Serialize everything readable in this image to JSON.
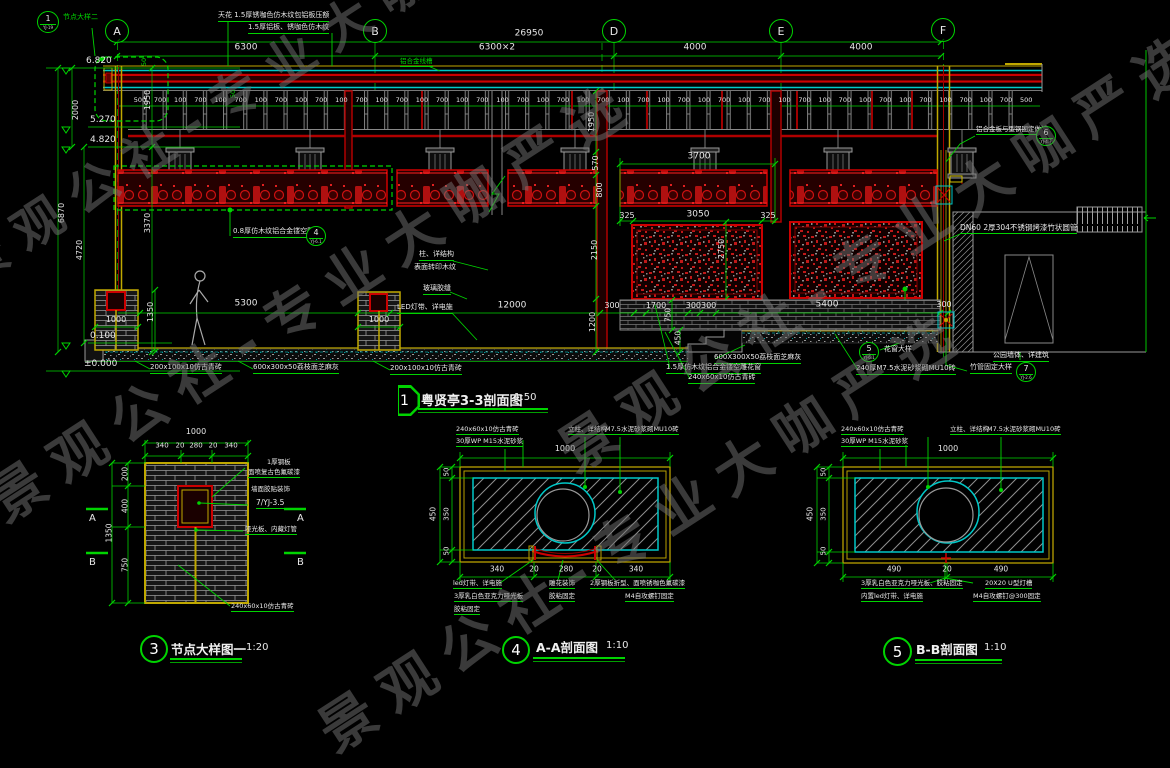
{
  "watermark": {
    "text": "景观公社-专业大咖严选"
  },
  "palette": {
    "green": "#00d400",
    "red": "#cc0000",
    "cyan": "#00c8c8",
    "yellow": "#c0a800",
    "white": "#e8e8e8",
    "bg": "#000000"
  },
  "grid_bubbles": {
    "labels": [
      "A",
      "B",
      "D",
      "E",
      "F"
    ]
  },
  "titles": [
    {
      "num": "1",
      "name": "粤贤亭3-3剖面图",
      "scale": "1:50"
    },
    {
      "num": "3",
      "name": "节点大样图一",
      "scale": "1:20"
    },
    {
      "num": "4",
      "name": "A-A剖面图",
      "scale": "1:10"
    },
    {
      "num": "5",
      "name": "B-B剖面图",
      "scale": "1:10"
    }
  ],
  "detail_bubbles": [
    {
      "num": "1",
      "ref": "YJ-19"
    },
    {
      "num": "4",
      "ref": "YJ-6.1"
    },
    {
      "num": "5",
      "ref": "YJ-6.1"
    },
    {
      "num": "6",
      "ref": "YJ-4.7"
    },
    {
      "num": "7",
      "ref": "YJ-2.6"
    }
  ],
  "rail_dims": {
    "values": [
      "500",
      "700",
      "100",
      "700",
      "100",
      "700",
      "100",
      "700",
      "100",
      "700",
      "100",
      "700",
      "100",
      "700",
      "100",
      "700",
      "100",
      "700",
      "100",
      "700",
      "100",
      "700",
      "100",
      "700",
      "100",
      "700",
      "100",
      "700",
      "100",
      "700",
      "100",
      "700",
      "100",
      "700",
      "100",
      "700",
      "100",
      "700",
      "100",
      "700",
      "100",
      "700",
      "100",
      "700",
      "500"
    ]
  },
  "watermarks": [
    {
      "x": -30,
      "y": 470,
      "rot": -33,
      "size": 56
    },
    {
      "x": 300,
      "y": 700,
      "rot": -33,
      "size": 56
    },
    {
      "x": 540,
      "y": 420,
      "rot": -33,
      "size": 56
    },
    {
      "x": -60,
      "y": 240,
      "rot": -33,
      "size": 50
    }
  ],
  "annotations": [
    {
      "t": "26950",
      "x": 529,
      "y": 34,
      "c": "w",
      "s": 9,
      "a": "c"
    },
    {
      "t": "6300",
      "x": 246,
      "y": 48,
      "c": "w",
      "s": 9,
      "a": "c"
    },
    {
      "t": "6300×2",
      "x": 497,
      "y": 48,
      "c": "w",
      "s": 9,
      "a": "c"
    },
    {
      "t": "4000",
      "x": 695,
      "y": 48,
      "c": "w",
      "s": 9,
      "a": "c"
    },
    {
      "t": "4000",
      "x": 861,
      "y": 48,
      "c": "w",
      "s": 9,
      "a": "c"
    },
    {
      "t": "天花 1.5厚锈咖色仿木纹包铝板压额",
      "x": 218,
      "y": 12,
      "c": "w",
      "s": 7,
      "u": 1
    },
    {
      "t": "1.5厚铝板、锈咖色仿木纹",
      "x": 248,
      "y": 24,
      "c": "w",
      "s": 7,
      "u": 1
    },
    {
      "t": "铝合金线槽",
      "x": 400,
      "y": 58,
      "c": "g",
      "s": 6.5,
      "u": 1
    },
    {
      "t": "节点大样二",
      "x": 63,
      "y": 14,
      "c": "g",
      "s": 7
    },
    {
      "t": "6.820",
      "x": 86,
      "y": 57,
      "c": "w",
      "s": 9
    },
    {
      "t": "5.270",
      "x": 90,
      "y": 116,
      "c": "w",
      "s": 9
    },
    {
      "t": "4.820",
      "x": 90,
      "y": 136,
      "c": "w",
      "s": 9
    },
    {
      "t": "0.100",
      "x": 90,
      "y": 332,
      "c": "w",
      "s": 9
    },
    {
      "t": "±0.000",
      "x": 84,
      "y": 360,
      "c": "w",
      "s": 9
    },
    {
      "t": "2000",
      "x": 76,
      "y": 110,
      "r": 1,
      "c": "w",
      "s": 8
    },
    {
      "t": "6870",
      "x": 62,
      "y": 213,
      "r": 1,
      "c": "w",
      "s": 8
    },
    {
      "t": "4720",
      "x": 80,
      "y": 250,
      "r": 1,
      "c": "w",
      "s": 8
    },
    {
      "t": "1950",
      "x": 148,
      "y": 100,
      "r": 1,
      "c": "w",
      "s": 8
    },
    {
      "t": "3370",
      "x": 148,
      "y": 223,
      "r": 1,
      "c": "w",
      "s": 8
    },
    {
      "t": "50",
      "x": 144,
      "y": 62,
      "r": 1,
      "c": "g",
      "s": 6.5
    },
    {
      "t": "50",
      "x": 233,
      "y": 94,
      "r": 1,
      "c": "g",
      "s": 6.5
    },
    {
      "t": "1950",
      "x": 592,
      "y": 122,
      "r": 1,
      "c": "w",
      "s": 8
    },
    {
      "t": "570",
      "x": 596,
      "y": 163,
      "r": 1,
      "c": "w",
      "s": 8
    },
    {
      "t": "800",
      "x": 600,
      "y": 190,
      "r": 1,
      "c": "w",
      "s": 8
    },
    {
      "t": "2150",
      "x": 595,
      "y": 250,
      "r": 1,
      "c": "w",
      "s": 8
    },
    {
      "t": "1200",
      "x": 593,
      "y": 322,
      "r": 1,
      "c": "w",
      "s": 8
    },
    {
      "t": "2750",
      "x": 722,
      "y": 249,
      "r": 1,
      "c": "w",
      "s": 8
    },
    {
      "t": "750",
      "x": 668,
      "y": 315,
      "r": 1,
      "c": "w",
      "s": 7.5
    },
    {
      "t": "450",
      "x": 678,
      "y": 338,
      "r": 1,
      "c": "w",
      "s": 7.5
    },
    {
      "t": "1350",
      "x": 151,
      "y": 312,
      "r": 1,
      "c": "w",
      "s": 8
    },
    {
      "t": "3700",
      "x": 699,
      "y": 157,
      "c": "w",
      "s": 9,
      "a": "c"
    },
    {
      "t": "325",
      "x": 627,
      "y": 216,
      "c": "w",
      "s": 8,
      "a": "c"
    },
    {
      "t": "3050",
      "x": 698,
      "y": 215,
      "c": "w",
      "s": 9,
      "a": "c"
    },
    {
      "t": "325",
      "x": 768,
      "y": 216,
      "c": "w",
      "s": 8,
      "a": "c"
    },
    {
      "t": "5300",
      "x": 246,
      "y": 304,
      "c": "w",
      "s": 9,
      "a": "c"
    },
    {
      "t": "1000",
      "x": 116,
      "y": 320,
      "c": "w",
      "s": 8,
      "a": "c"
    },
    {
      "t": "1000",
      "x": 379,
      "y": 320,
      "c": "w",
      "s": 8,
      "a": "c"
    },
    {
      "t": "12000",
      "x": 512,
      "y": 306,
      "c": "w",
      "s": 9,
      "a": "c"
    },
    {
      "t": "300",
      "x": 612,
      "y": 306,
      "c": "w",
      "s": 8,
      "a": "c"
    },
    {
      "t": "1700",
      "x": 656,
      "y": 306,
      "c": "w",
      "s": 8,
      "a": "c"
    },
    {
      "t": "300300",
      "x": 701,
      "y": 306,
      "c": "w",
      "s": 8,
      "a": "c"
    },
    {
      "t": "5400",
      "x": 827,
      "y": 305,
      "c": "w",
      "s": 9,
      "a": "c"
    },
    {
      "t": "300",
      "x": 944,
      "y": 305,
      "c": "w",
      "s": 8,
      "a": "c"
    },
    {
      "t": "柱、详结构",
      "x": 419,
      "y": 251,
      "c": "w",
      "s": 7,
      "u": 1
    },
    {
      "t": "表面转印木纹",
      "x": 414,
      "y": 264,
      "c": "w",
      "s": 7
    },
    {
      "t": "玻璃胶缝",
      "x": 423,
      "y": 285,
      "c": "w",
      "s": 7,
      "u": 1
    },
    {
      "t": "LED灯带、详电施",
      "x": 397,
      "y": 304,
      "c": "w",
      "s": 7,
      "u": 1
    },
    {
      "t": "0.8厚仿木纹铝合金镂空雕花",
      "x": 233,
      "y": 228,
      "c": "w",
      "s": 7,
      "u": 1
    },
    {
      "t": "200x100x10仿古青砖",
      "x": 150,
      "y": 364,
      "c": "w",
      "s": 7,
      "u": 1
    },
    {
      "t": "600x300x50荔枝面芝麻灰",
      "x": 253,
      "y": 364,
      "c": "w",
      "s": 7,
      "u": 1
    },
    {
      "t": "200x100x10仿古青砖",
      "x": 390,
      "y": 365,
      "c": "w",
      "s": 7,
      "u": 1
    },
    {
      "t": "600X300X50荔枝面芝麻灰",
      "x": 714,
      "y": 354,
      "c": "w",
      "s": 7,
      "u": 1
    },
    {
      "t": "1.5厚仿木纹铝合金镂空雕花窗",
      "x": 666,
      "y": 364,
      "c": "w",
      "s": 7,
      "u": 1
    },
    {
      "t": "240x60x10仿古青砖",
      "x": 688,
      "y": 374,
      "c": "w",
      "s": 7,
      "u": 1
    },
    {
      "t": "240厚M7.5水泥砂浆砌MU10砖",
      "x": 856,
      "y": 365,
      "c": "w",
      "s": 7,
      "u": 1
    },
    {
      "t": "公园墙体、详建筑",
      "x": 993,
      "y": 352,
      "c": "w",
      "s": 7,
      "u": 1
    },
    {
      "t": "竹管固定大样",
      "x": 970,
      "y": 364,
      "c": "w",
      "s": 7,
      "u": 1
    },
    {
      "t": "花窗大样",
      "x": 884,
      "y": 346,
      "c": "w",
      "s": 7
    },
    {
      "t": "DN60 2厚304不锈钢烤漆竹状圆管",
      "x": 960,
      "y": 224,
      "c": "w",
      "s": 7.5,
      "u": 1
    },
    {
      "t": "铝合金板与型钢固定做法",
      "x": 976,
      "y": 126,
      "c": "w",
      "s": 6.5,
      "u": 1
    },
    {
      "t": "1000",
      "x": 196,
      "y": 432,
      "c": "w",
      "s": 8,
      "a": "c"
    },
    {
      "t": "340",
      "x": 162,
      "y": 446,
      "c": "w",
      "s": 7,
      "a": "c"
    },
    {
      "t": "20",
      "x": 180,
      "y": 446,
      "c": "w",
      "s": 7,
      "a": "c"
    },
    {
      "t": "280",
      "x": 196,
      "y": 446,
      "c": "w",
      "s": 7,
      "a": "c"
    },
    {
      "t": "20",
      "x": 213,
      "y": 446,
      "c": "w",
      "s": 7,
      "a": "c"
    },
    {
      "t": "340",
      "x": 231,
      "y": 446,
      "c": "w",
      "s": 7,
      "a": "c"
    },
    {
      "t": "200",
      "x": 125,
      "y": 474,
      "r": 1,
      "c": "w",
      "s": 7.5
    },
    {
      "t": "400",
      "x": 125,
      "y": 506,
      "r": 1,
      "c": "w",
      "s": 7.5
    },
    {
      "t": "750",
      "x": 125,
      "y": 565,
      "r": 1,
      "c": "w",
      "s": 7.5
    },
    {
      "t": "1350",
      "x": 109,
      "y": 533,
      "r": 1,
      "c": "w",
      "s": 7.5
    },
    {
      "t": "A",
      "x": 89,
      "y": 514,
      "c": "w",
      "s": 10
    },
    {
      "t": "A",
      "x": 297,
      "y": 514,
      "c": "w",
      "s": 10
    },
    {
      "t": "B",
      "x": 89,
      "y": 558,
      "c": "w",
      "s": 10
    },
    {
      "t": "B",
      "x": 297,
      "y": 558,
      "c": "w",
      "s": 10
    },
    {
      "t": "1厚钢板",
      "x": 267,
      "y": 459,
      "c": "w",
      "s": 6.5
    },
    {
      "t": "面喷复古色氟碳漆",
      "x": 248,
      "y": 469,
      "c": "w",
      "s": 6.5,
      "u": 1
    },
    {
      "t": "墙面胶贴装饰",
      "x": 251,
      "y": 486,
      "c": "w",
      "s": 6.5
    },
    {
      "t": "7/YJ-3.5",
      "x": 256,
      "y": 499,
      "c": "w",
      "s": 7.5,
      "u": 1
    },
    {
      "t": "哑光板、内藏灯管",
      "x": 245,
      "y": 526,
      "c": "w",
      "s": 6.5,
      "u": 1
    },
    {
      "t": "240x60x10仿古青砖",
      "x": 231,
      "y": 603,
      "c": "w",
      "s": 6.5,
      "u": 1
    },
    {
      "t": "1000",
      "x": 565,
      "y": 449,
      "c": "w",
      "s": 8,
      "a": "c"
    },
    {
      "t": "450",
      "x": 433,
      "y": 514,
      "r": 1,
      "c": "w",
      "s": 7.5
    },
    {
      "t": "50",
      "x": 447,
      "y": 472,
      "r": 1,
      "c": "w",
      "s": 7
    },
    {
      "t": "350",
      "x": 447,
      "y": 514,
      "r": 1,
      "c": "w",
      "s": 7
    },
    {
      "t": "50",
      "x": 447,
      "y": 551,
      "r": 1,
      "c": "w",
      "s": 7
    },
    {
      "t": "340",
      "x": 497,
      "y": 569,
      "c": "w",
      "s": 7.5,
      "a": "c"
    },
    {
      "t": "20",
      "x": 534,
      "y": 569,
      "c": "w",
      "s": 7.5,
      "a": "c"
    },
    {
      "t": "280",
      "x": 566,
      "y": 569,
      "c": "w",
      "s": 7.5,
      "a": "c"
    },
    {
      "t": "20",
      "x": 597,
      "y": 569,
      "c": "w",
      "s": 7.5,
      "a": "c"
    },
    {
      "t": "340",
      "x": 636,
      "y": 569,
      "c": "w",
      "s": 7.5,
      "a": "c"
    },
    {
      "t": "240x60x10仿古青砖",
      "x": 456,
      "y": 426,
      "c": "w",
      "s": 6.5,
      "u": 1
    },
    {
      "t": "30厚WP M15水泥砂浆",
      "x": 456,
      "y": 438,
      "c": "w",
      "s": 6.5,
      "u": 1
    },
    {
      "t": "立柱、详结构",
      "x": 568,
      "y": 426,
      "c": "w",
      "s": 6.5,
      "u": 1
    },
    {
      "t": "M7.5水泥砂浆砌MU10砖",
      "x": 605,
      "y": 426,
      "c": "w",
      "s": 6.5,
      "u": 1
    },
    {
      "t": "led灯带、详电施",
      "x": 453,
      "y": 580,
      "c": "w",
      "s": 6.5,
      "u": 1
    },
    {
      "t": "3厚乳白色亚克力哑光板",
      "x": 454,
      "y": 593,
      "c": "w",
      "s": 6.5,
      "u": 1
    },
    {
      "t": "胶粘固定",
      "x": 454,
      "y": 606,
      "c": "w",
      "s": 6.5,
      "u": 1
    },
    {
      "t": "雕花装饰",
      "x": 549,
      "y": 580,
      "c": "w",
      "s": 6.5,
      "u": 1
    },
    {
      "t": "胶粘固定",
      "x": 549,
      "y": 593,
      "c": "w",
      "s": 6.5,
      "u": 1
    },
    {
      "t": "2厚钢板折型、面喷锈咖色氟碳漆",
      "x": 590,
      "y": 580,
      "c": "w",
      "s": 6.5,
      "u": 1
    },
    {
      "t": "M4自攻螺钉固定",
      "x": 625,
      "y": 593,
      "c": "w",
      "s": 6.5,
      "u": 1
    },
    {
      "t": "1000",
      "x": 948,
      "y": 449,
      "c": "w",
      "s": 8,
      "a": "c"
    },
    {
      "t": "450",
      "x": 810,
      "y": 514,
      "r": 1,
      "c": "w",
      "s": 7.5
    },
    {
      "t": "50",
      "x": 824,
      "y": 472,
      "r": 1,
      "c": "w",
      "s": 7
    },
    {
      "t": "350",
      "x": 824,
      "y": 514,
      "r": 1,
      "c": "w",
      "s": 7
    },
    {
      "t": "50",
      "x": 824,
      "y": 551,
      "r": 1,
      "c": "w",
      "s": 7
    },
    {
      "t": "490",
      "x": 894,
      "y": 569,
      "c": "w",
      "s": 7.5,
      "a": "c"
    },
    {
      "t": "20",
      "x": 947,
      "y": 569,
      "c": "w",
      "s": 7.5,
      "a": "c"
    },
    {
      "t": "490",
      "x": 1001,
      "y": 569,
      "c": "w",
      "s": 7.5,
      "a": "c"
    },
    {
      "t": "240x60x10仿古青砖",
      "x": 841,
      "y": 426,
      "c": "w",
      "s": 6.5,
      "u": 1
    },
    {
      "t": "30厚WP M15水泥砂浆",
      "x": 841,
      "y": 438,
      "c": "w",
      "s": 6.5,
      "u": 1
    },
    {
      "t": "立柱、详结构",
      "x": 950,
      "y": 426,
      "c": "w",
      "s": 6.5,
      "u": 1
    },
    {
      "t": "M7.5水泥砂浆砌MU10砖",
      "x": 987,
      "y": 426,
      "c": "w",
      "s": 6.5,
      "u": 1
    },
    {
      "t": "3厚乳白色亚克力哑光板、胶粘固定",
      "x": 861,
      "y": 580,
      "c": "w",
      "s": 6.5,
      "u": 1
    },
    {
      "t": "内置led灯带、详电施",
      "x": 861,
      "y": 593,
      "c": "w",
      "s": 6.5,
      "u": 1
    },
    {
      "t": "20X20 U型灯槽",
      "x": 985,
      "y": 580,
      "c": "w",
      "s": 6.5,
      "u": 1
    },
    {
      "t": "M4自攻螺钉@300固定",
      "x": 973,
      "y": 593,
      "c": "w",
      "s": 6.5,
      "u": 1
    }
  ]
}
